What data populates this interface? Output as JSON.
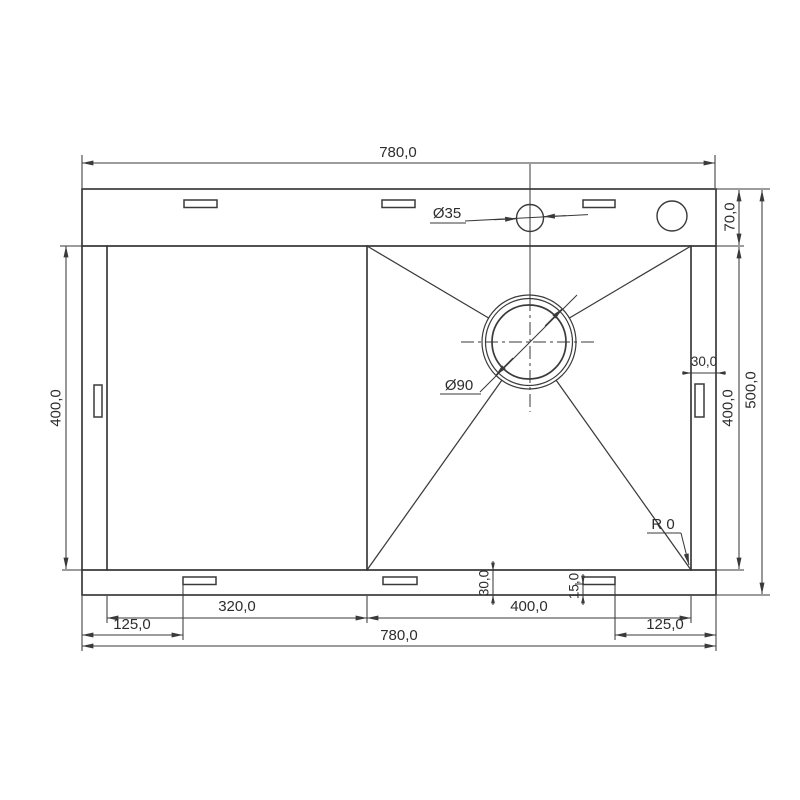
{
  "drawing": {
    "subject": "kitchen sink top-view technical drawing",
    "line_color": "#3a3a3a",
    "background": "#ffffff",
    "labels": {
      "overall_width_top": "780,0",
      "overall_width_bottom": "780,0",
      "overall_depth": "500,0",
      "top_deck_depth": "70,0",
      "left_section_depth": "400,0",
      "bowl_depth": "400,0",
      "left_section_width": "320,0",
      "bowl_width": "400,0",
      "right_deck_width": "30,0",
      "bottom_deck_depth": "30,0",
      "slot_edge_offset": "15,0",
      "slot_offset_left": "125,0",
      "slot_offset_right": "125,0",
      "faucet_hole_diameter": "Ø35",
      "drain_hole_diameter": "Ø90",
      "corner_radius": "R 0"
    }
  }
}
